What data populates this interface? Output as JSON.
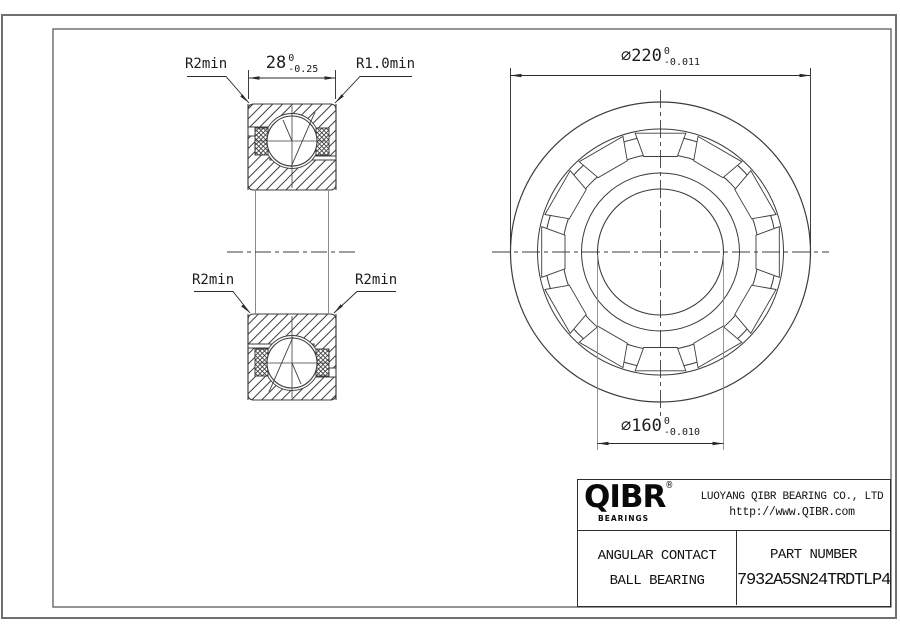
{
  "drawing": {
    "section_labels": {
      "r_top_left": "R2min",
      "r_top_right": "R1.0min",
      "r_bottom_left": "R2min",
      "r_bottom_right": "R2min",
      "width_dim": {
        "value": "28",
        "tol_upper": "0",
        "tol_lower": "-0.25"
      }
    },
    "front_dims": {
      "outer_diameter": {
        "value": "⌀220",
        "tol_upper": "0",
        "tol_lower": "-0.011"
      },
      "bore_diameter": {
        "value": "⌀160",
        "tol_upper": "0",
        "tol_lower": "-0.010"
      }
    }
  },
  "title_block": {
    "brand": "QIBR",
    "brand_mark": "®",
    "brand_sub": "BEARINGS",
    "company": "LUOYANG QIBR BEARING CO., LTD",
    "website": "http://www.QIBR.com",
    "product_line1": "ANGULAR CONTACT",
    "product_line2": "BALL BEARING",
    "part_number_label": "PART NUMBER",
    "part_number": "7932A5SN24TRDTLP4"
  },
  "colors": {
    "line": "#3c3c3c",
    "muted_line": "#8a8a8a",
    "border": "#707070",
    "text": "#111111",
    "background": "#ffffff"
  }
}
